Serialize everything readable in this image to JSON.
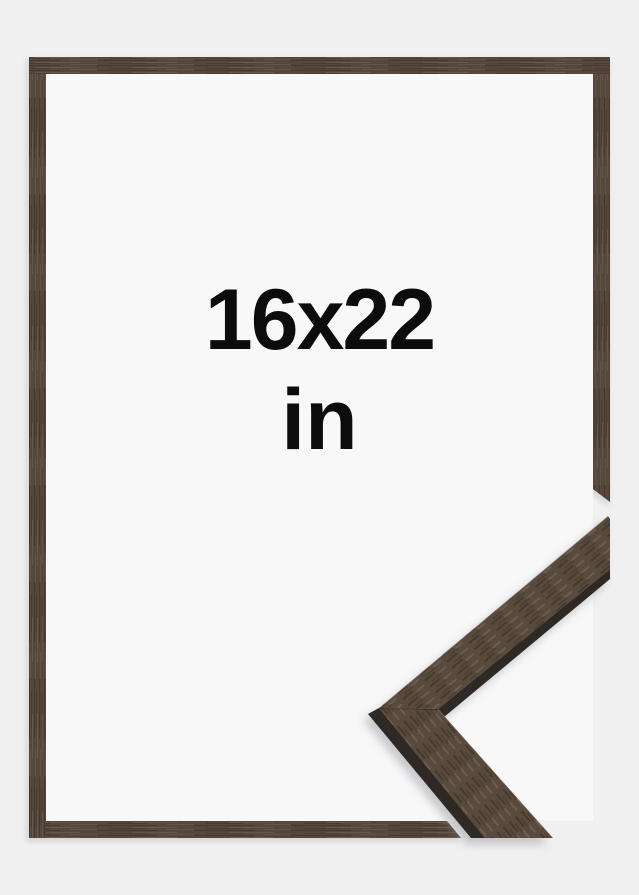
{
  "label": {
    "size": "16x22",
    "unit": "in"
  },
  "graphics": {
    "subject": "picture-frame-product-photo",
    "frame_material": "dark-walnut-wood",
    "detail": "mitered-moulding-corner-sample"
  },
  "colors": {
    "background": "#f0f0f1",
    "interior": "#f8f8f9",
    "wood_frame": "#54473a",
    "wood_detail": "#584a3c",
    "wood_edge": "#2e2924",
    "text_color": "#0c0c0c"
  }
}
